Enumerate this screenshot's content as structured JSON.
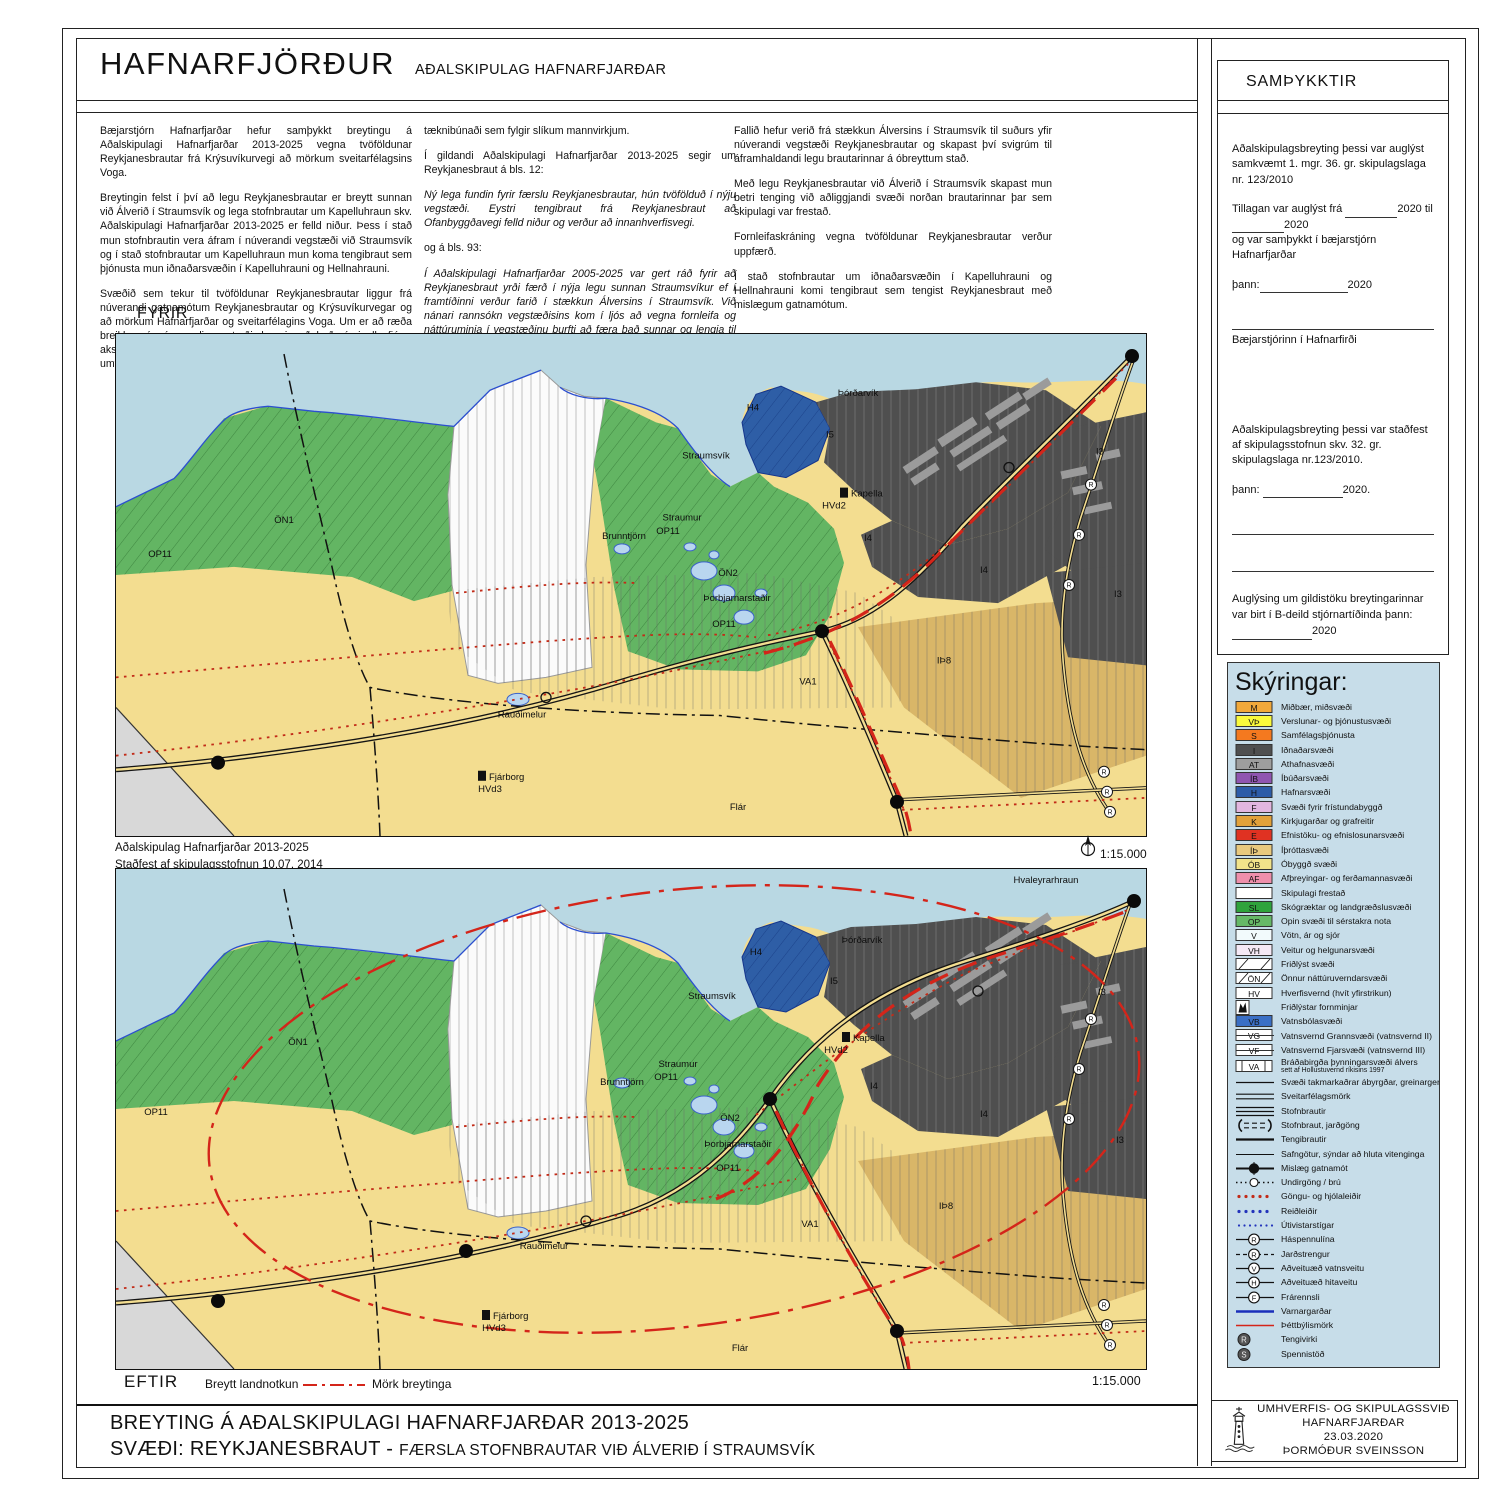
{
  "header": {
    "municipality": "HAFNARFJÖRÐUR",
    "plan_title": "AÐALSKIPULAG HAFNARFJARÐAR"
  },
  "intro": {
    "col1": [
      "Bæjarstjórn Hafnarfjarðar hefur samþykkt breytingu á Aðalskipulagi Hafnarfjarðar 2013-2025 vegna tvöföldunar Reykjanesbrautar frá Krýsuvíkurvegi að mörkum sveitarfélagsins Voga.",
      "Breytingin felst í því að legu Reykjanesbrautar er breytt sunnan við Álverið í Straumsvík og lega stofnbrautar um Kapelluhraun skv. Aðalskipulagi Hafnarfjarðar 2013-2025 er felld niður. Þess í stað mun stofnbrautin vera áfram í núverandi vegstæði við Straumsvík og í stað stofnbrautar um Kapelluhraun mun koma tengibraut sem þjónusta mun iðnaðarsvæðin í Kapelluhrauni og Hellnahrauni.",
      "Svæðið sem tekur til tvöföldunar Reykjanesbrautar liggur frá núverandi gatnamótum Reykjanesbrautar og Krýsuvíkurvegar og að mörkum Hafnarfjarðar og sveitarfélagins Voga. Um er að ræða breikkun á núverandi vegstæði, þannig að það rúmi alls fjórar akstursgreinar, tvær í hvora átt ásamt tilheyrandi umferðarmannvirkjum, öruggissvæðum og"
    ],
    "col2": [
      {
        "t": "tæknibúnaði sem fylgir slíkum mannvirkjum.",
        "i": false
      },
      {
        "t": "Í gildandi Aðalskipulagi Hafnarfjarðar 2013-2025 segir um Reykjanesbraut á bls. 12:",
        "i": false
      },
      {
        "t": "Ný lega fundin fyrir færslu Reykjanesbrautar, hún tvöfölduð í nýju vegstæði. Eystri tengibraut frá Reykjanesbraut að Ofanbyggðavegi felld niður og verður að innanhverfisvegi.",
        "i": true
      },
      {
        "t": "og á bls. 93:",
        "i": false
      },
      {
        "t": "Í Aðalskipulagi Hafnarfjarðar 2005-2025 var gert ráð fyrir að Reykjanesbraut yrði færð í nýja legu sunnan Straumsvíkur ef í framtíðinni verður farið í stækkun Álversins í Straumsvík. Við nánari rannsókn vegstæðisins kom í ljós að vegna fornleifa og náttúruminja í vegstæðinu þurfti að færa það sunnar og lengja til muna, og í endurskoðun aðalskipulagsins er brautin sett í nýtt vegstæði í samræmi við niðurstöður rannsóknarinnar, sem unnin var í samvinnu við Vegagerðina",
        "i": true
      }
    ],
    "col3": [
      "Fallið hefur verið frá stækkun Álversins í Straumsvík til suðurs yfir núverandi vegstæði Reykjanesbrautar og skapast því svigrúm til áframhaldandi legu brautarinnar á óbreyttum stað.",
      "Með legu Reykjanesbrautar við Álverið í Straumsvík skapast mun betri tenging við aðliggjandi svæði norðan brautarinnar þar sem skipulagi var frestað.",
      "Fornleifaskráning vegna tvöföldunar Reykjanesbrautar verður uppfærð.",
      "Í stað stofnbrautar um iðnaðarsvæðin í Kapelluhrauni og Hellnahrauni komi tengibraut sem tengist Reykjanesbraut með mislægum gatnamótum."
    ]
  },
  "map_before": {
    "label": "FYRIR",
    "scale": "1:15.000",
    "labels": [
      {
        "t": "ÖN1",
        "x": 168,
        "y": 188
      },
      {
        "t": "OP11",
        "x": 44,
        "y": 222
      },
      {
        "t": "Brunntjörn",
        "x": 508,
        "y": 204
      },
      {
        "t": "Straumur",
        "x": 566,
        "y": 186
      },
      {
        "t": "OP11",
        "x": 552,
        "y": 199
      },
      {
        "t": "Straumsvík",
        "x": 590,
        "y": 124
      },
      {
        "t": "ÖN2",
        "x": 612,
        "y": 241
      },
      {
        "t": "Þorbjarnarstaðir",
        "x": 621,
        "y": 266
      },
      {
        "t": "OP11",
        "x": 608,
        "y": 292
      },
      {
        "t": "H4",
        "x": 637,
        "y": 76
      },
      {
        "t": "Þórðarvík",
        "x": 742,
        "y": 62
      },
      {
        "t": "I5",
        "x": 714,
        "y": 103
      },
      {
        "t": "Kapella",
        "x": 744,
        "y": 162,
        "icon": true
      },
      {
        "t": "HVd2",
        "x": 718,
        "y": 174
      },
      {
        "t": "I4",
        "x": 752,
        "y": 206
      },
      {
        "t": "I4",
        "x": 868,
        "y": 238
      },
      {
        "t": "I3",
        "x": 984,
        "y": 120
      },
      {
        "t": "I3",
        "x": 1002,
        "y": 262
      },
      {
        "t": "IÞ8",
        "x": 828,
        "y": 328
      },
      {
        "t": "VA1",
        "x": 692,
        "y": 349
      },
      {
        "t": "Rauðimelur",
        "x": 406,
        "y": 382
      },
      {
        "t": "Fjárborg",
        "x": 382,
        "y": 444,
        "icon": true
      },
      {
        "t": "HVd3",
        "x": 374,
        "y": 456
      },
      {
        "t": "Flár",
        "x": 622,
        "y": 474
      }
    ]
  },
  "caption": {
    "line1": "Aðalskipulag Hafnarfjarðar 2013-2025",
    "line2": "Staðfest  af skipulagsstofnun 10.07. 2014"
  },
  "map_after": {
    "label": "EFTIR",
    "changed_label": "Breytt landnotkun",
    "boundary_label": "Mörk breytinga",
    "scale": "1:15.000",
    "labels": [
      {
        "t": "ÖN1",
        "x": 182,
        "y": 176
      },
      {
        "t": "OP11",
        "x": 40,
        "y": 246
      },
      {
        "t": "Brunntjörn",
        "x": 506,
        "y": 216
      },
      {
        "t": "Straumur",
        "x": 562,
        "y": 198
      },
      {
        "t": "OP11",
        "x": 550,
        "y": 211
      },
      {
        "t": "Straumsvík",
        "x": 596,
        "y": 130
      },
      {
        "t": "ÖN2",
        "x": 614,
        "y": 252
      },
      {
        "t": "Þorbjarnarstaðir",
        "x": 622,
        "y": 278
      },
      {
        "t": "OP11",
        "x": 612,
        "y": 302
      },
      {
        "t": "H4",
        "x": 640,
        "y": 86
      },
      {
        "t": "Þórðarvík",
        "x": 746,
        "y": 74
      },
      {
        "t": "I5",
        "x": 718,
        "y": 115
      },
      {
        "t": "Kapella",
        "x": 746,
        "y": 172,
        "icon": true
      },
      {
        "t": "HVd2",
        "x": 720,
        "y": 184
      },
      {
        "t": "I4",
        "x": 758,
        "y": 220
      },
      {
        "t": "I4",
        "x": 868,
        "y": 248
      },
      {
        "t": "I3",
        "x": 986,
        "y": 126
      },
      {
        "t": "I3",
        "x": 1004,
        "y": 274
      },
      {
        "t": "IÞ8",
        "x": 830,
        "y": 340
      },
      {
        "t": "VA1",
        "x": 694,
        "y": 358
      },
      {
        "t": "Rauðimelur",
        "x": 428,
        "y": 380
      },
      {
        "t": "Fjárborg",
        "x": 386,
        "y": 450,
        "icon": true
      },
      {
        "t": "HVd3",
        "x": 378,
        "y": 462
      },
      {
        "t": "Flár",
        "x": 624,
        "y": 482
      },
      {
        "t": "Hvaleyrarhraun",
        "x": 930,
        "y": 14
      }
    ]
  },
  "footer": {
    "line1": "BREYTING Á AÐALSKIPULAGI HAFNARFJARÐAR 2013-2025",
    "line2a": "SVÆÐI: REYKJANESBRAUT - ",
    "line2b": "FÆRSLA STOFNBRAUTAR VIÐ ÁLVERIÐ Í STRAUMSVÍK"
  },
  "approvals": {
    "heading": "SAMÞYKKTIR",
    "p1": "Aðalskipulagsbreyting þessi var auglýst samkvæmt 1. mgr. 36. gr. skipulagslaga nr. 123/2010",
    "p2_pre": "Tillagan var auglýst frá",
    "p2_year1": "2020 til",
    "p2_year2": "2020",
    "p2_line2": "og var samþykkt í bæjarstjórn Hafnarfjarðar",
    "p3_pre": "þann:",
    "p3_year": "2020",
    "sig1": "Bæjarstjórinn í Hafnarfirði",
    "p4": "Aðalskipulagsbreyting þessi var staðfest af skipulagsstofnun  skv. 32. gr. skipulagslaga nr.123/2010.",
    "p5_pre": "þann:",
    "p5_year": "2020.",
    "p6_pre": "Auglýsing um gildistöku breytingarinnar var birt í B-deild stjórnartíðinda þann:",
    "p6_year": "2020"
  },
  "legend": {
    "heading": "Skýringar:",
    "items": [
      {
        "type": "box",
        "code": "M",
        "bg": "#F2A93B",
        "label": "Miðbær, miðsvæði"
      },
      {
        "type": "box",
        "code": "VÞ",
        "bg": "#FAFA3C",
        "label": "Verslunar- og þjónustusvæði"
      },
      {
        "type": "box",
        "code": "S",
        "bg": "#F4791F",
        "label": "Samfélagsþjónusta"
      },
      {
        "type": "box",
        "code": "I",
        "bg": "#4F4F4F",
        "label": "Iðnaðarsvæði"
      },
      {
        "type": "box",
        "code": "AT",
        "bg": "#9E9E9E",
        "label": "Athafnasvæði"
      },
      {
        "type": "box",
        "code": "ÍB",
        "bg": "#9055B0",
        "label": "Íbúðarsvæði"
      },
      {
        "type": "box",
        "code": "H",
        "bg": "#2D5CA8",
        "label": "Hafnarsvæði"
      },
      {
        "type": "box",
        "code": "F",
        "bg": "#E2B6DF",
        "label": "Svæði fyrir frístundabyggð"
      },
      {
        "type": "box",
        "code": "K",
        "bg": "#E2A13A",
        "label": "Kirkjugarðar og grafreitir"
      },
      {
        "type": "box",
        "code": "E",
        "bg": "#E03222",
        "label": "Efnistöku- og efnislosunarsvæði"
      },
      {
        "type": "box",
        "code": "ÍÞ",
        "bg": "#E9C97E",
        "label": "Íþróttasvæði"
      },
      {
        "type": "box",
        "code": "ÓB",
        "bg": "#F2E38A",
        "label": "Óbyggð svæði"
      },
      {
        "type": "box",
        "code": "AF",
        "bg": "#EE8FAB",
        "label": "Afþreyingar- og ferðamannasvæði"
      },
      {
        "type": "box",
        "code": "",
        "bg": "#FFFFFF",
        "label": "Skipulagi frestað"
      },
      {
        "type": "box",
        "code": "SL",
        "bg": "#2FA33C",
        "label": "Skógræktar og landgræðslusvæði"
      },
      {
        "type": "box",
        "code": "OP",
        "bg": "#66B967",
        "label": "Opin svæði til sérstakra nota"
      },
      {
        "type": "box",
        "code": "V",
        "bg": "#F2FAFC",
        "label": "Vötn, ár og sjór"
      },
      {
        "type": "box",
        "code": "VH",
        "bg": "#F5E9F5",
        "label": "Veitur og helgunarsvæði"
      },
      {
        "type": "hatch",
        "code": "",
        "label": "Friðlýst svæði"
      },
      {
        "type": "hatch",
        "code": "ÖN",
        "label": "Önnur náttúruverndarsvæði"
      },
      {
        "type": "box",
        "code": "HV",
        "bg": "#FFFFFF",
        "label": "Hverfisvernd (hvít yfirstrikun)"
      },
      {
        "type": "monument",
        "code": "",
        "label": "Friðlýstar fornminjar"
      },
      {
        "type": "box",
        "code": "VB",
        "bg": "#3A6FC5",
        "label": "Vatnsbólasvæði"
      },
      {
        "type": "strike",
        "code": "VG",
        "label": "Vatnsvernd Grannsvæði (vatnsvernd II)"
      },
      {
        "type": "strike",
        "code": "VF",
        "label": "Vatnsvernd Fjarsvæði (vatnsvernd III)"
      },
      {
        "type": "bars",
        "code": "VA",
        "label": "Bráðabirgða þynningarsvæði álvers",
        "sub": "sett af Hollustuvernd ríkisins 1997"
      },
      {
        "type": "line-thin",
        "label": "Svæði takmarkaðrar ábyrgðar, greinargerð 2,2,6 íðr"
      },
      {
        "type": "line-double",
        "label": "Sveitarfélagsmörk"
      },
      {
        "type": "line-triple",
        "label": "Stofnbrautir"
      },
      {
        "type": "tunnel",
        "label": "Stofnbraut, jarðgöng"
      },
      {
        "type": "line-medium",
        "label": "Tengibrautir"
      },
      {
        "type": "line-thin2",
        "label": "Safngötur, sýndar að hluta vitenginga"
      },
      {
        "type": "junction",
        "label": "Mislæg gatnamót"
      },
      {
        "type": "underpass",
        "label": "Undirgöng / brú"
      },
      {
        "type": "dots-red",
        "label": "Göngu- og hjólaleiðir"
      },
      {
        "type": "dots-blue",
        "label": "Reiðleiðir"
      },
      {
        "type": "dots-blue-sm",
        "label": "Útivistarstígar"
      },
      {
        "type": "circle-letter",
        "letter": "R",
        "label": "Háspennulína"
      },
      {
        "type": "circle-letter-dash",
        "letter": "R",
        "label": "Jarðstrengur"
      },
      {
        "type": "circle-letter",
        "letter": "V",
        "label": "Aðveituæð vatnsveitu"
      },
      {
        "type": "circle-letter",
        "letter": "H",
        "label": "Aðveituæð hitaveitu"
      },
      {
        "type": "circle-letter",
        "letter": "F",
        "label": "Frárennsli"
      },
      {
        "type": "line-blue",
        "label": "Varnargarðar"
      },
      {
        "type": "line-red",
        "label": "Þéttbýlismörk"
      },
      {
        "type": "fcircle",
        "letter": "R",
        "label": "Tengivirki"
      },
      {
        "type": "fcircle",
        "letter": "S",
        "label": "Spennistöð"
      }
    ]
  },
  "stamp": {
    "lines": [
      "UMHVERFIS- OG SKIPULAGSSVIÐ",
      "HAFNARFJARÐAR",
      "23.03.2020",
      "ÞORMÓÐUR SVEINSSON"
    ]
  },
  "colors": {
    "sea": "#b9d8e3",
    "land": "#f3dd90",
    "green": "#63b563",
    "industry": "#4f4f4f",
    "harbor": "#2e5ea6",
    "tan": "#d9b668",
    "legend_bg": "#c7dde9",
    "change_red": "#d4251a",
    "path_red": "#c22b18"
  }
}
